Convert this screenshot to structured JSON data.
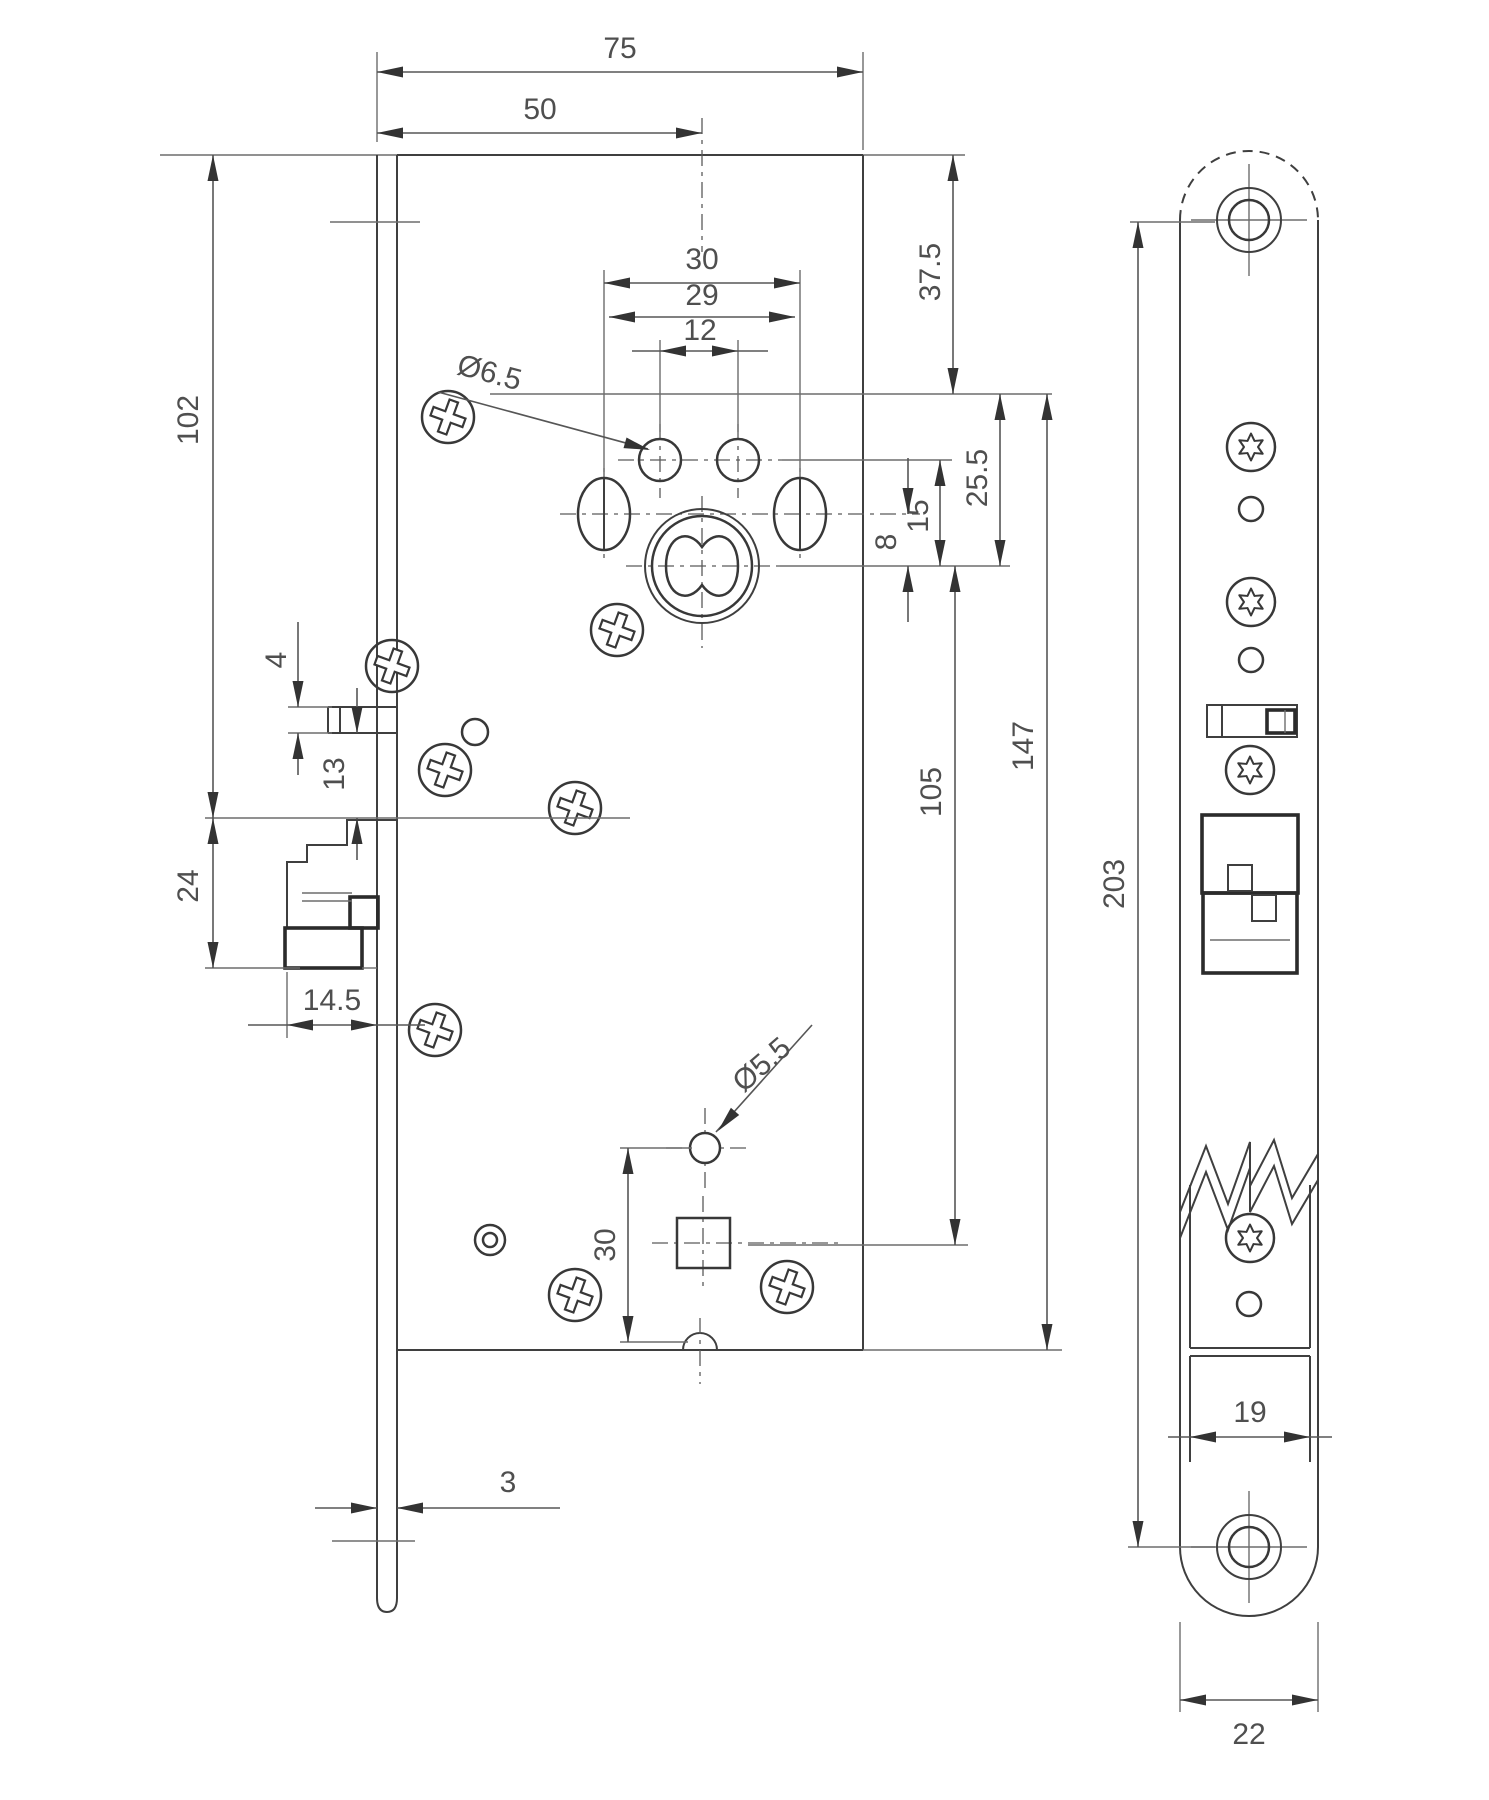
{
  "drawing": {
    "type": "technical-dimension-drawing",
    "subject": "mortise door lock case and faceplate",
    "units": "mm",
    "colors": {
      "line": "#3f3f3f",
      "dim": "#565656",
      "background": "#ffffff"
    },
    "views": {
      "left": "lock case side view with faceplate edge",
      "right": "faceplate front view"
    },
    "dims": {
      "case_depth": "75",
      "backset": "50",
      "slot_span_outer": "30",
      "slot_span_centers": "29",
      "hole_pair_span": "12",
      "top_hole_dia": "Ø6.5",
      "top_to_hole_row": "37.5",
      "top_to_latch": "102",
      "top_row_to_cyl": "25.5",
      "holes_to_cyl": "15",
      "slots_to_cyl": "8",
      "aux_step": "4",
      "aux_to_latch": "13",
      "latch_height": "24",
      "latch_throw": "14.5",
      "cyl_to_square": "105",
      "case_height": "147",
      "screw_centers": "203",
      "small_hole_dia": "Ø5.5",
      "square_to_bottom": "30",
      "plate_thickness": "3",
      "plate_inner_width": "19",
      "plate_width": "22"
    }
  }
}
